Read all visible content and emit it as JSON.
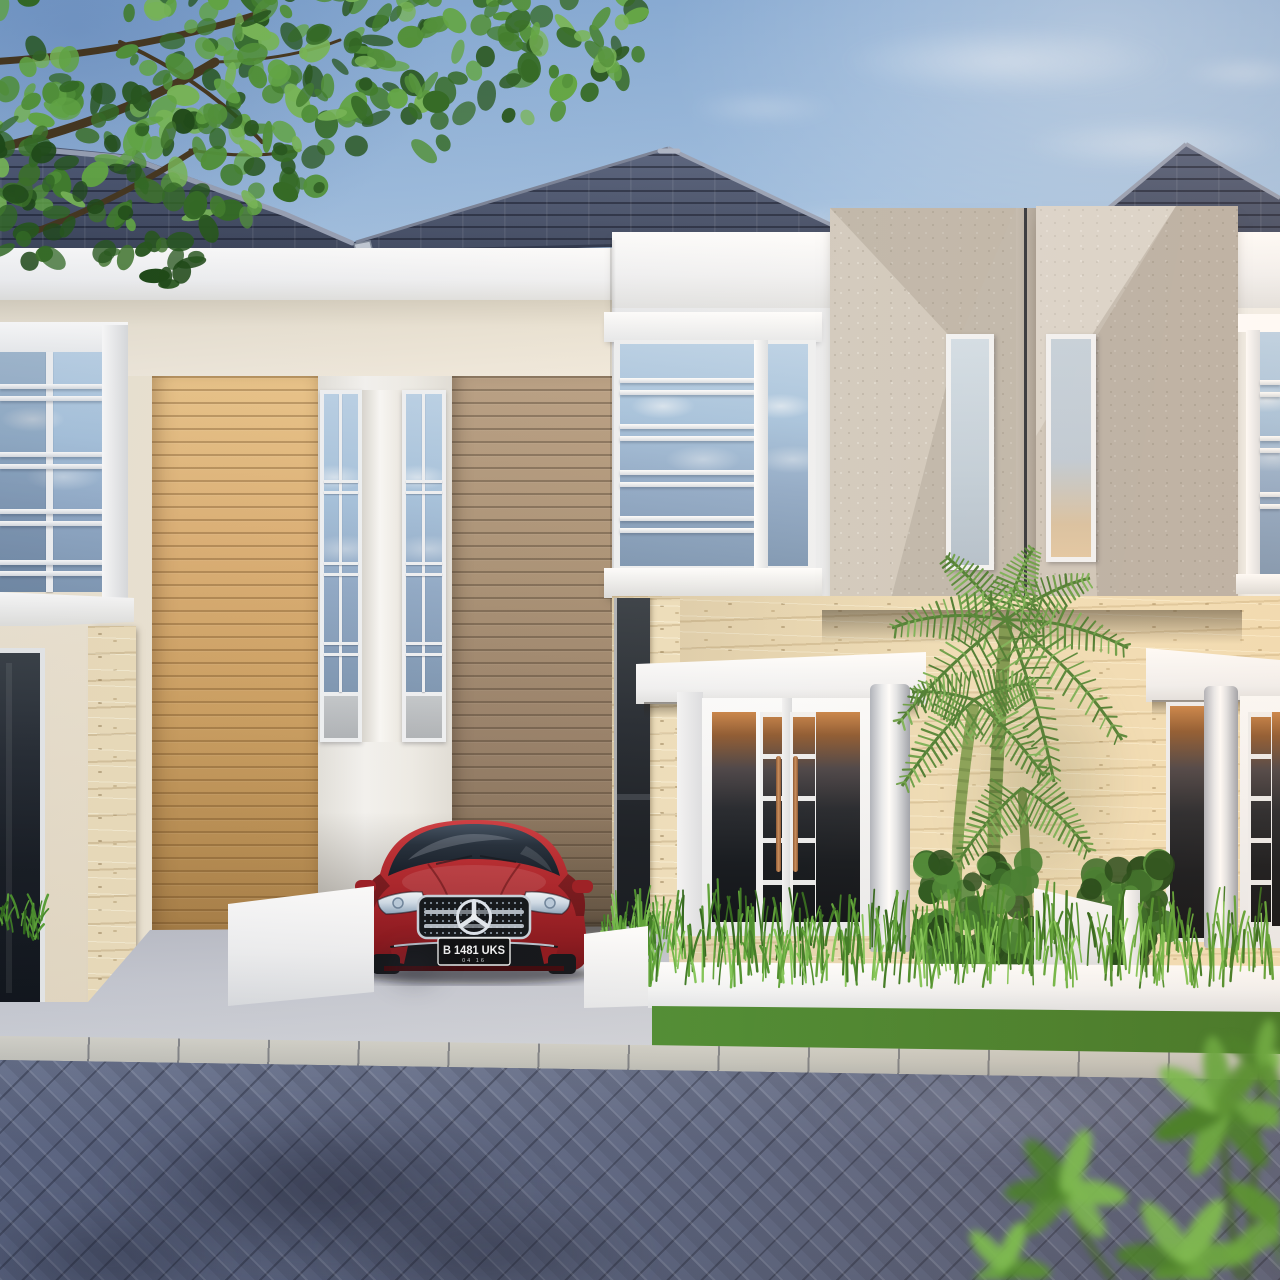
{
  "scene": {
    "type": "exterior-architectural-render",
    "description": "Dusk 3D rendering of a pair of modern minimalist two-storey houses with dark hip roofs, timber slat feature panels, bevelled concrete monolith panels with slot windows, rough limestone lower walls, tropical landscaping, and a red coupe parked in the carport facing a herringbone paver street.",
    "sky": {
      "condition": "clear with wispy clouds",
      "time_of_day": "dusk"
    },
    "vehicle": {
      "kind": "red coupe",
      "emblem": "mercedes-star-icon",
      "plate_number": "B 1481 UKS",
      "plate_expiry": "04 16"
    },
    "left_house": {
      "elements": [
        "hip roof",
        "corner louver bay window",
        "light oak slat panel",
        "two mullioned tall windows",
        "grey timber slat panel",
        "carport with low white wall",
        "dark glazed entry"
      ]
    },
    "right_house": {
      "elements": [
        "hip roofs",
        "louvered picture window",
        "two bevelled concrete feature panels with slot windows",
        "rough limestone facade",
        "columned porches",
        "french doors with dusk reflections",
        "white planter walls"
      ]
    },
    "landscaping": [
      "overhanging tree canopy",
      "palm cluster",
      "clipped shrubs",
      "ornamental grass hedge",
      "lawn strip",
      "blurred foreground foliage"
    ],
    "ground": [
      "concrete driveway",
      "kerb with curved joints",
      "herringbone paver road with tree shadows"
    ]
  },
  "colors": {
    "skyTop": "#86abd6",
    "skyMid": "#b7cfe8",
    "skyLow": "#dce9f4",
    "roofDark": "#3d4659",
    "roofMid": "#4f5a74",
    "roofRidge": "#99a2b6",
    "fascia": "#f6f7f8",
    "wallWhite": "#eef0f2",
    "wallCream": "#efe7d6",
    "soffit": "#ece5d6",
    "woodLight": "#d8ab6c",
    "woodDark": "#9c8669",
    "glassSky": "#a9c5df",
    "glassDark": "#161c24",
    "glassSunset": "#b9763d",
    "stone": "#eedfbd",
    "panelLight": "#d2cbc0",
    "panelDark": "#b6afa5",
    "carRed": "#b01f27",
    "plateBg": "#0b0d10",
    "plateText": "#f2f3f5",
    "copper": "#b87a4e",
    "grass": "#5fae3a",
    "lawn": "#4e8c33",
    "bush": "#2a5a20",
    "palm": "#6a9c46",
    "foliage": "#417f2c",
    "trunkBrown": "#46371f",
    "driveway": "#c7cad3",
    "curb": "#c4c4bd",
    "street": "#5d6784",
    "fgGreen": "#5a9e3b"
  }
}
